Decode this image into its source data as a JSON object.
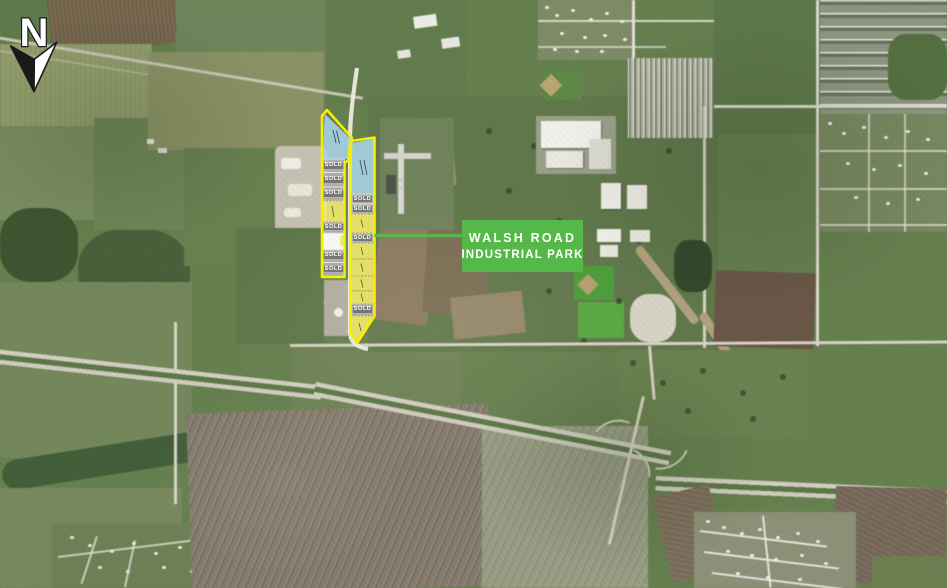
{
  "title_card": {
    "line1": "WALSH ROAD",
    "line2": "INDUSTRIAL PARK"
  },
  "north_indicator": {
    "label": "N"
  },
  "parcels": {
    "sold_label": "SOLD",
    "sold_count": 10,
    "available_blue_count": 2,
    "available_yellow_count": 8,
    "available_white_count": 1
  },
  "theme": {
    "brand_green": "#54b948",
    "title_text": "#ffffff",
    "parcel_outline": "#f8ee00",
    "available_blue": "#a6d4e8",
    "available_yellow": "#f1e96d",
    "available_white": "#fcfcf9",
    "sold_parcel_fill": "#b2b1ad",
    "sold_tag_bg": "#767676",
    "sold_tag_text": "#ffffff"
  }
}
